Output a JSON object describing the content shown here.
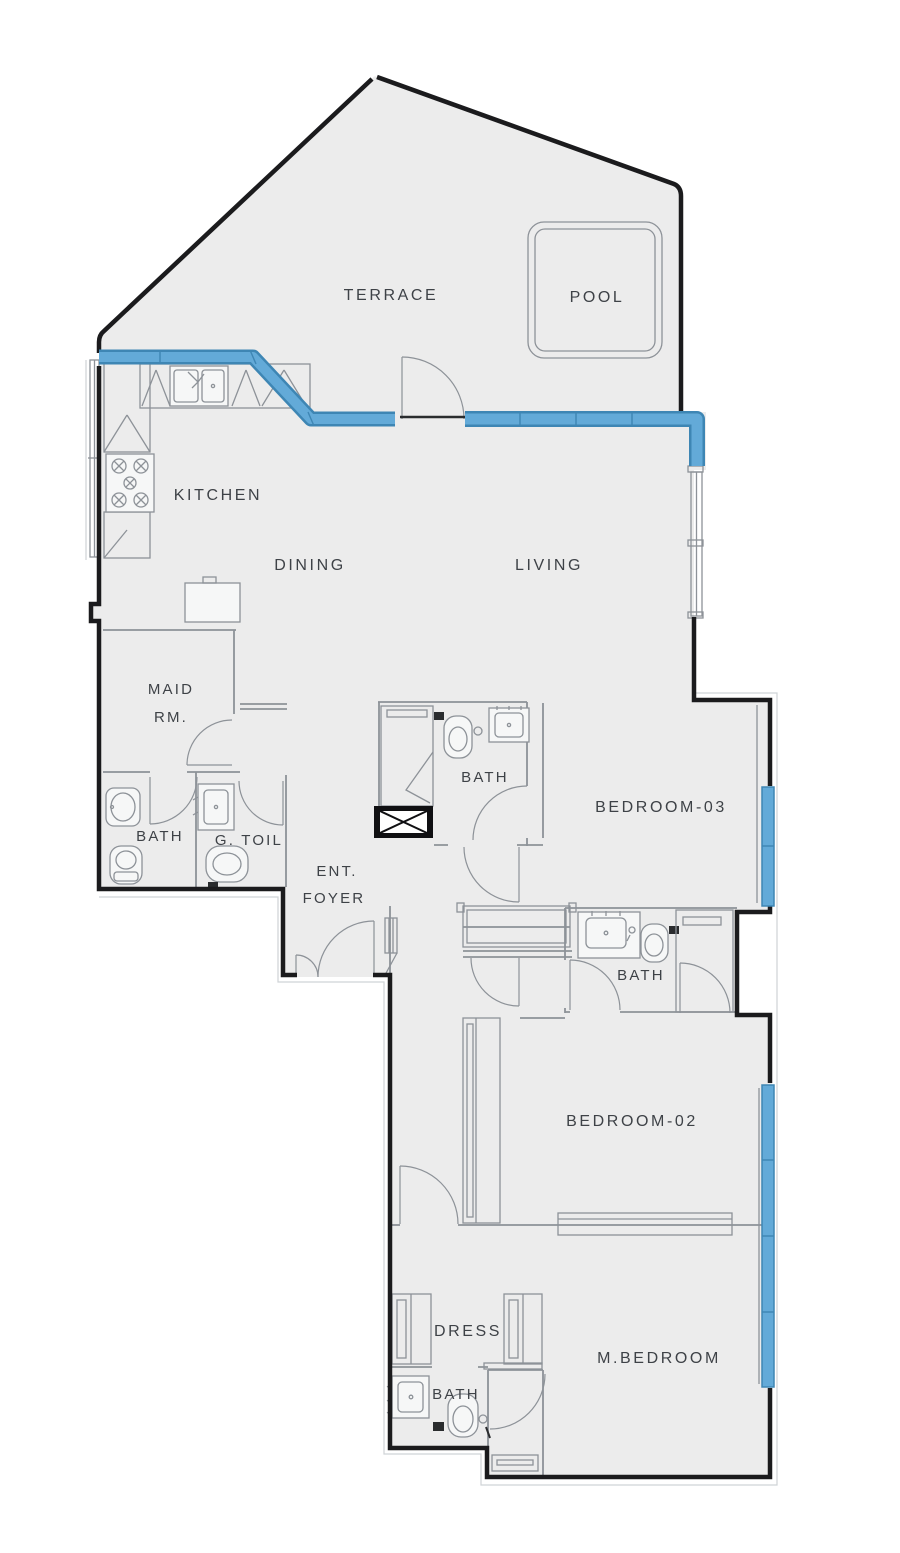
{
  "plan": {
    "type": "apartment-floor-plan",
    "rooms": {
      "terrace": "TERRACE",
      "pool": "POOL",
      "kitchen": "KITCHEN",
      "dining": "DINING",
      "living": "LIVING",
      "maid_room_line1": "MAID",
      "maid_room_line2": "RM.",
      "maid_bath": "BATH",
      "guest_toilet": "G. TOIL",
      "foyer_line1": "ENT.",
      "foyer_line2": "FOYER",
      "bath_bedroom3": "BATH",
      "bedroom3": "BEDROOM-03",
      "bath_bedroom2": "BATH",
      "bedroom2": "BEDROOM-02",
      "dress": "DRESS",
      "master_bath": "BATH",
      "master_bedroom": "M.BEDROOM"
    },
    "colors": {
      "exterior_wall": "#1b1b1d",
      "partition_line": "#8d9298",
      "floor_fill": "#ececec",
      "background": "#ffffff",
      "glazing_fill": "#63aad8",
      "glazing_edge": "#3e86b4",
      "label_text": "#3e4247",
      "offset_line": "#cfd3d6"
    }
  }
}
